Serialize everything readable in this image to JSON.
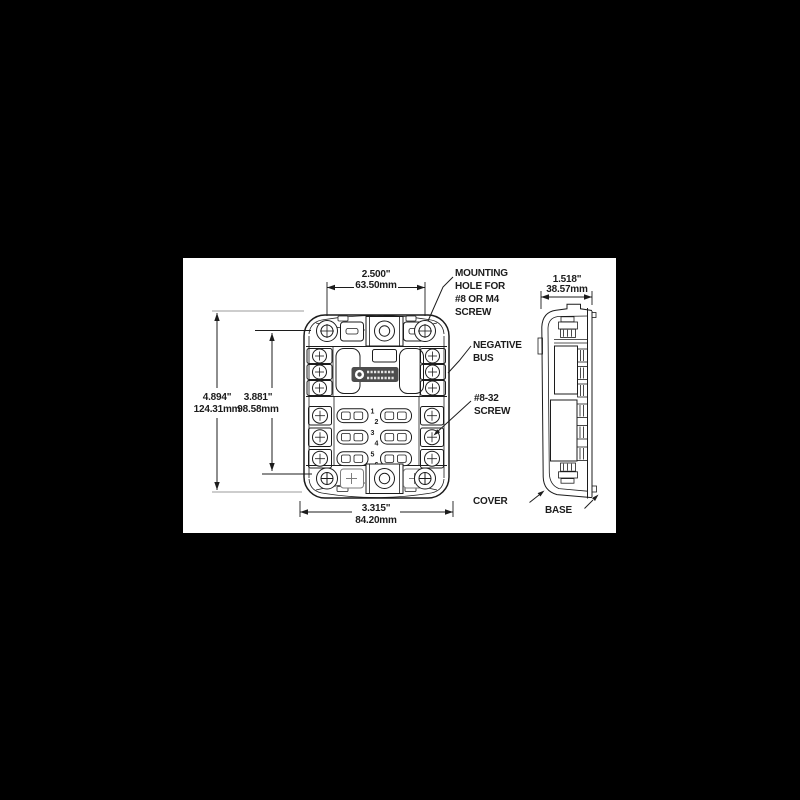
{
  "colors": {
    "background": "#000000",
    "paper": "#ffffff",
    "ink": "#1c1c1c",
    "ink_light": "#9b9b9b",
    "ink_mid": "#4d4d4d"
  },
  "front_view": {
    "dims": {
      "width_top": {
        "inches": "2.500\"",
        "mm": "63.50mm"
      },
      "height_overall": {
        "inches": "4.894\"",
        "mm": "124.31mm"
      },
      "height_mounting": {
        "inches": "3.881\"",
        "mm": "98.58mm"
      },
      "width_bottom": {
        "inches": "3.315\"",
        "mm": "84.20mm"
      }
    },
    "circuit_numbers": [
      "1",
      "2",
      "3",
      "4",
      "5",
      "6"
    ]
  },
  "side_view": {
    "dims": {
      "depth": {
        "inches": "1.518\"",
        "mm": "38.57mm"
      }
    }
  },
  "callouts": {
    "mounting_hole": [
      "MOUNTING",
      "HOLE FOR",
      "#8 OR M4",
      "SCREW"
    ],
    "negative_bus": [
      "NEGATIVE",
      "BUS"
    ],
    "screw_8_32": [
      "#8-32",
      "SCREW"
    ],
    "cover": "COVER",
    "base": "BASE"
  }
}
